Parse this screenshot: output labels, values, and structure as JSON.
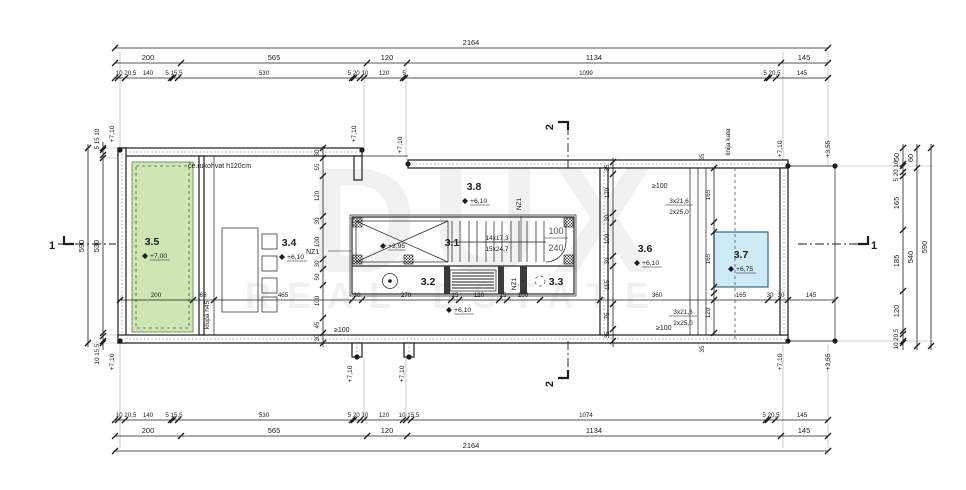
{
  "watermark": {
    "line1": "DUX",
    "line2": "REAL ESTATE"
  },
  "dims": {
    "top": {
      "total": "2164",
      "row2": [
        "200",
        "565",
        "120",
        "1134",
        "145"
      ],
      "row3": [
        "10 20,5",
        "140",
        "5 15,5",
        "530",
        "5 20 10",
        "120",
        "5",
        "1099",
        "5 20,5",
        "145"
      ]
    },
    "bottom": {
      "row1": [
        "10 20,5",
        "140",
        "5 15,5",
        "530",
        "5 20 10",
        "120",
        "10 15,5",
        "1074",
        "5 20,5",
        "145"
      ],
      "row2": [
        "200",
        "565",
        "120",
        "1134",
        "145"
      ],
      "total": "2164"
    },
    "left": {
      "outer": "590",
      "inner": "530",
      "top_cluster": "5 15 10",
      "bottom_cluster": "10 15,5"
    },
    "right": {
      "chain1": [
        "50",
        "5 20 10",
        "165",
        "185",
        "120",
        "10 20,5"
      ],
      "chain2": [
        "60",
        "540"
      ],
      "outer": "590"
    },
    "interior": [
      "200",
      "65",
      "465",
      "30",
      "270",
      "25",
      "120",
      "25",
      "100",
      "360",
      "165",
      "30",
      "30",
      "145"
    ],
    "chain_a": [
      "30",
      "55",
      "120",
      "30",
      "100",
      "30",
      "50",
      "100",
      "45",
      "30"
    ],
    "chain_b": [
      "35",
      "120",
      "30",
      "100",
      "30",
      "115",
      "75",
      "35"
    ],
    "chain_c": [
      "165",
      "165",
      "120"
    ],
    "offsets": [
      "35",
      "35"
    ]
  },
  "rooms": {
    "r31": {
      "number": "3.1"
    },
    "r32": {
      "number": "3.2"
    },
    "r33": {
      "number": "3.3"
    },
    "r34": {
      "number": "3.4",
      "elev": "+6,10"
    },
    "r35": {
      "number": "3.5",
      "elev": "+7,00"
    },
    "r36": {
      "number": "3.6",
      "elev": "+6,10"
    },
    "r37": {
      "number": "3.7",
      "elev": "+6,75"
    },
    "r38": {
      "number": "3.8",
      "elev": "+6,10"
    }
  },
  "stair": {
    "riser_note": "14x17,3",
    "tread_note": "15x24,7",
    "door_width": "100",
    "door_height": "240",
    "landing_elev": "+6,10",
    "void_elev": "+2,95"
  },
  "steps": {
    "line1": "3x21,6",
    "line2": "2x25,0"
  },
  "elevations": {
    "p710": "+7,10",
    "p355": "+3,55"
  },
  "annotations": {
    "handrail": "če.rukohvat h120cm",
    "bench": "klupa h45",
    "floor_line": "linija kata",
    "wall_tag": "NZ1",
    "min_width": "≥100"
  },
  "sections": {
    "s1": "1",
    "s2": "2"
  }
}
